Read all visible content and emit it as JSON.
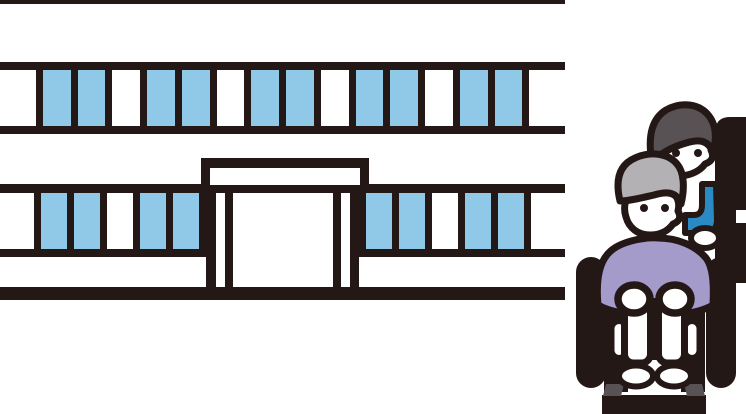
{
  "scene": {
    "title": "clinic building with caregiver pushing a senior in a wheelchair",
    "background_color": "#ffffff"
  },
  "palette": {
    "outline": "#231815",
    "window_blue": "#90c8e8",
    "clothes_purple": "#a49bca",
    "hair_light": "#b3b1b4",
    "hair_dark": "#595254",
    "sleeve_blue": "#2a8ac4",
    "metal_gray": "#595254"
  },
  "building": {
    "label": "hospital-building",
    "window_rows": {
      "row1": [
        "white",
        "blue",
        "blue",
        "white",
        "blue",
        "blue",
        "white",
        "blue",
        "blue",
        "white",
        "blue",
        "blue",
        "white",
        "blue",
        "blue",
        "white"
      ],
      "row2_left": [
        "white",
        "blue",
        "blue",
        "white",
        "blue",
        "blue"
      ],
      "row2_right": [
        "blue",
        "blue",
        "white",
        "blue",
        "blue",
        "white"
      ]
    },
    "entrance": {
      "columns": [
        {
          "w": 10,
          "color": "dark"
        },
        {
          "w": 9,
          "color": "white"
        },
        {
          "w": 8,
          "color": "dark"
        },
        {
          "w": 100,
          "color": "white"
        },
        {
          "w": 8,
          "color": "dark"
        },
        {
          "w": 9,
          "color": "white"
        },
        {
          "w": 9,
          "color": "dark"
        }
      ]
    }
  },
  "figures": {
    "front_person": "elderly-person-in-wheelchair",
    "back_person": "caregiver-pushing-wheelchair"
  }
}
